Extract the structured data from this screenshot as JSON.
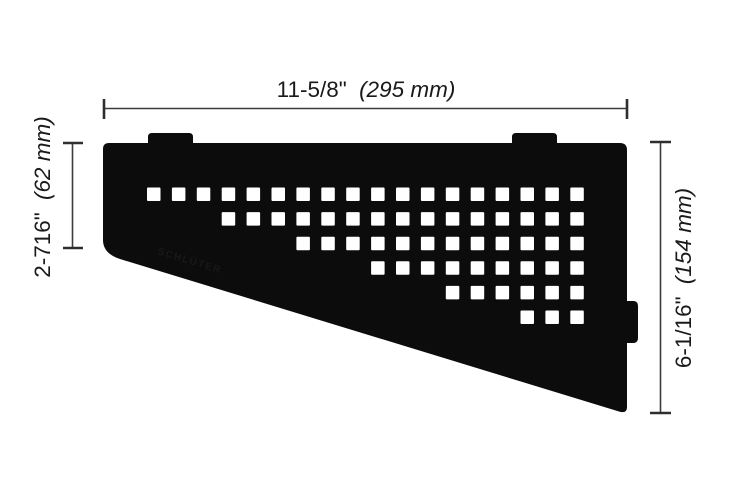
{
  "diagram": {
    "type": "technical-dimension-drawing",
    "subject": "quadrilateral corner shelf with square perforation pattern, two top mounting tabs and one right-edge mounting tab"
  },
  "dimensions": {
    "top": {
      "imperial": "11-5/8\"",
      "metric": "(295 mm)"
    },
    "left": {
      "imperial": "2-716\"",
      "metric": "(62 mm)"
    },
    "right": {
      "imperial": "6-1/16\"",
      "metric": "(154 mm)"
    }
  },
  "pattern": {
    "description": "staircase grid of square cutouts; each lower row starts 3 columns further right",
    "rows": 6,
    "columns": 18,
    "row_start_columns": [
      0,
      3,
      6,
      9,
      12,
      15
    ],
    "end_column": 17,
    "origin_x": 147,
    "origin_y": 187.5,
    "pitch_x": 24.9,
    "pitch_y": 24.6,
    "square_size": 13.5,
    "total_holes": 63
  },
  "logo_text": "SCHLÜTER",
  "colors": {
    "shelf": "#0c0c0c",
    "holes": "#ffffff",
    "dimension_lines": "#3c3c3c",
    "ticks": "#2e2e2e",
    "text": "#1a1a1a",
    "background": "#ffffff",
    "logo": "#181818"
  }
}
